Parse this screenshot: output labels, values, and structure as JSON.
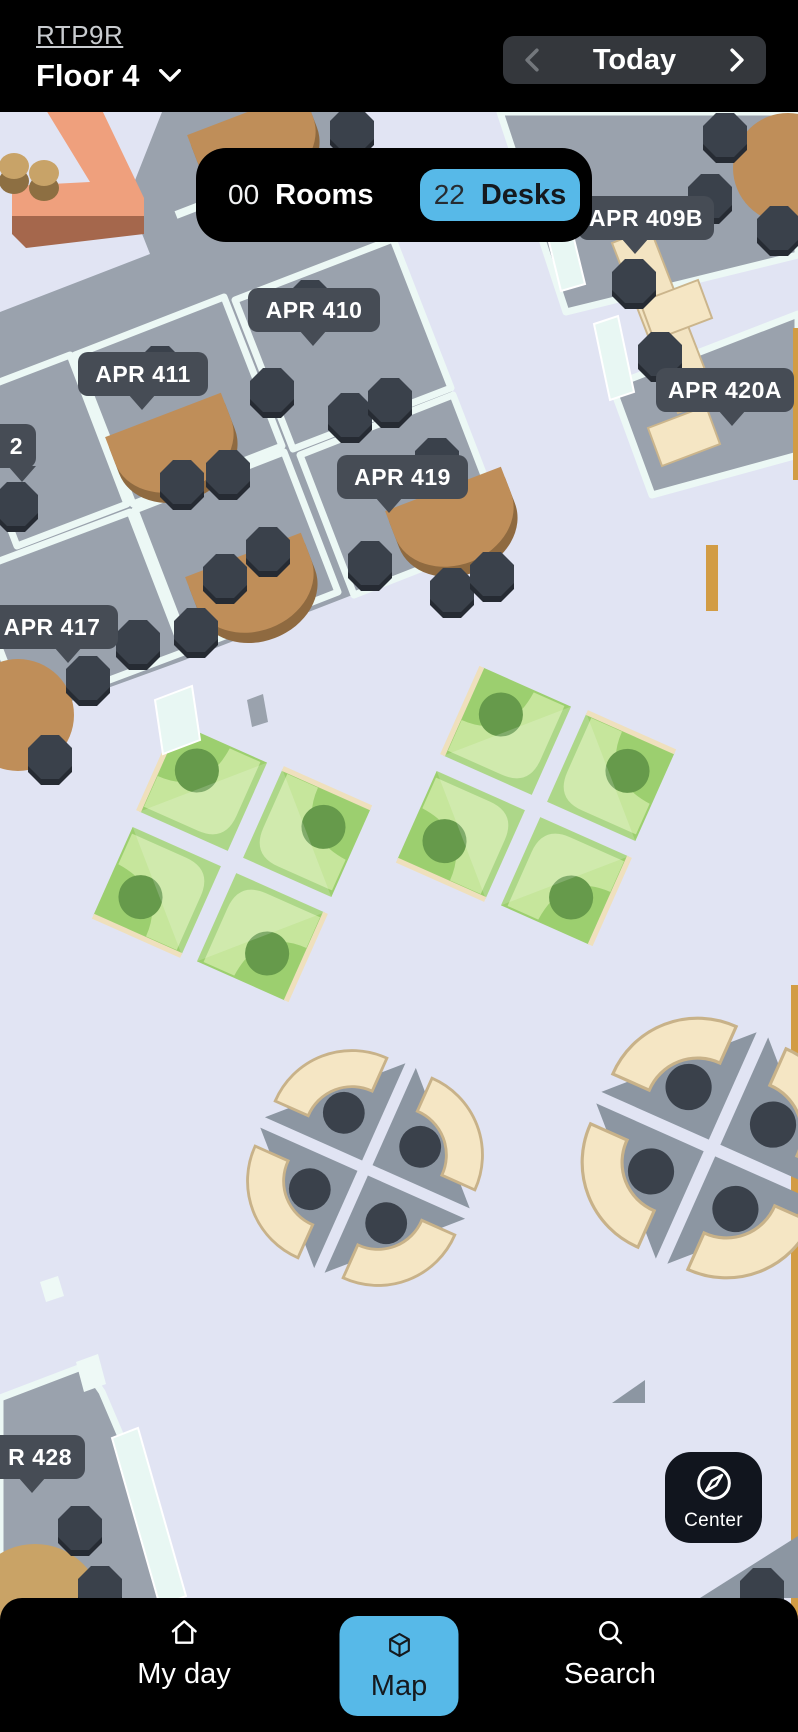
{
  "header": {
    "brand": "RTP9R",
    "floor": "Floor 4",
    "today_label": "Today"
  },
  "counts": {
    "rooms_value": "00",
    "rooms_label": "Rooms",
    "desks_value": "22",
    "desks_label": "Desks"
  },
  "map": {
    "center_button_label": "Center",
    "room_labels": [
      {
        "text": "APR 410",
        "x": 248,
        "y": 288,
        "w": 132,
        "pointer": 0.49,
        "align": "center"
      },
      {
        "text": "APR 411",
        "x": 78,
        "y": 352,
        "w": 130,
        "pointer": 0.49,
        "align": "center"
      },
      {
        "text": "APR 419",
        "x": 337,
        "y": 455,
        "w": 131,
        "pointer": 0.4,
        "align": "center"
      },
      {
        "text": "APR 409B",
        "x": 578,
        "y": 196,
        "w": 136,
        "pointer": 0.42,
        "align": "center"
      },
      {
        "text": "APR 420A",
        "x": 656,
        "y": 368,
        "w": 138,
        "pointer": 0.55,
        "align": "center"
      },
      {
        "text": "APR 417",
        "x": -14,
        "y": 605,
        "w": 132,
        "pointer": 0.62,
        "align": "center"
      },
      {
        "text": "2",
        "x": -80,
        "y": 424,
        "w": 116,
        "pointer": 0.88,
        "align": "right"
      },
      {
        "text": "R 428",
        "x": -58,
        "y": 1435,
        "w": 143,
        "pointer": 0.63,
        "align": "right"
      }
    ]
  },
  "nav": {
    "items": [
      {
        "label": "My day",
        "icon": "home-icon",
        "active": false
      },
      {
        "label": "Map",
        "icon": "cube-icon",
        "active": true
      },
      {
        "label": "Search",
        "icon": "search-icon",
        "active": false
      }
    ]
  },
  "colors": {
    "accent_blue": "#57b9e8",
    "label_bg": "#464c55",
    "map_background": "#e1e4f3",
    "room_floor": "#9aa2ad",
    "wall": "#ecf8f5",
    "desk_cream": "#f5e6c4",
    "desk_available_green": "#9ccf6f",
    "table_brown": "#bf8e59",
    "chair_dark": "#3a414b",
    "bench_orange": "#efa07d",
    "nav_bg": "#000000",
    "center_button_bg": "#11151e"
  }
}
